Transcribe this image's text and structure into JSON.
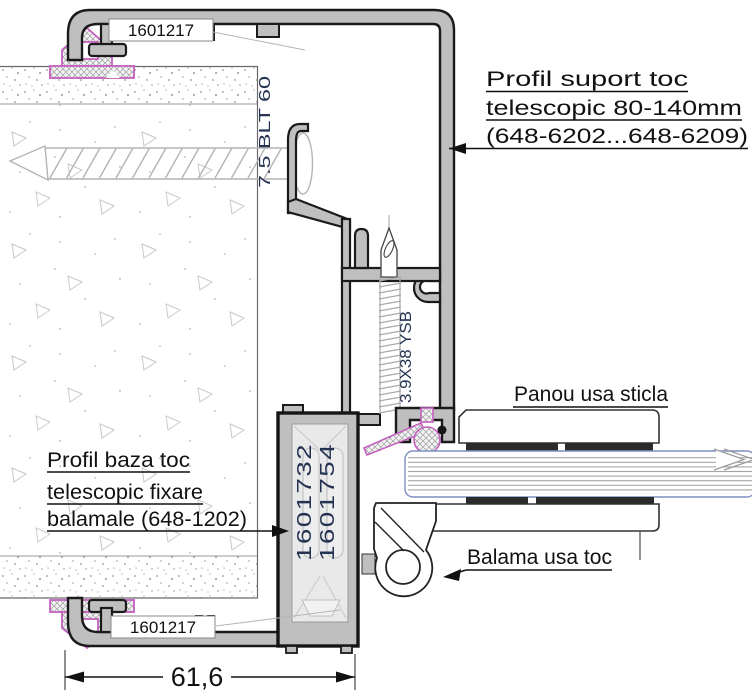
{
  "drawing": {
    "callouts": {
      "profil_suport": {
        "line1": "Profil suport toc",
        "line2": "telescopic 80-140mm",
        "line3": "(648-6202...648-6209)"
      },
      "panou_usa": "Panou usa sticla",
      "profil_baza": {
        "line1": "Profil baza toc",
        "line2": "telescopic fixare",
        "line3": "balamale (648-1202)"
      },
      "balama": "Balama usa toc"
    },
    "part_labels": {
      "top_gasket_clip": "1601217",
      "bottom_gasket_clip": "1601217",
      "base_profile_ref_a": "1601732",
      "base_profile_ref_b": "1601754",
      "wall_screw_spec": "7.5 BLT 60",
      "frame_screw_spec": "3.9X38 YSB"
    },
    "dimension_width": "61,6",
    "colors": {
      "metal_fill": "#bfbfbf",
      "outline": "#1a1a1a",
      "gasket_magenta": "#c45fc0",
      "spec_text_navy": "#253352",
      "glass_edge_blue": "#7d8fc2"
    }
  }
}
